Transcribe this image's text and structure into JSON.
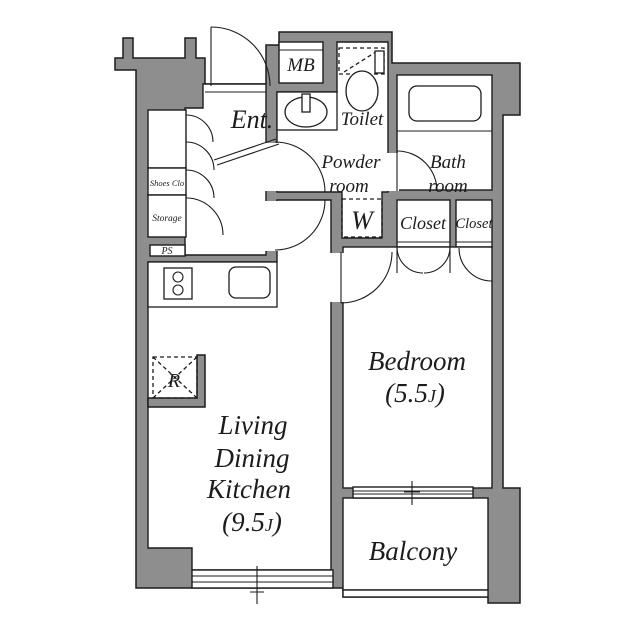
{
  "colors": {
    "wall_fill": "#8e8e8e",
    "line": "#1c1c1c",
    "floor": "#ffffff"
  },
  "rooms": {
    "entrance": {
      "label": "Ent."
    },
    "meter_box": {
      "label": "MB"
    },
    "toilet": {
      "label": "Toilet"
    },
    "powder_room": {
      "line1": "Powder",
      "line2": "room"
    },
    "bath_room": {
      "line1": "Bath",
      "line2": "room"
    },
    "washer_space": {
      "label": "W"
    },
    "closet_large": {
      "label": "Closet"
    },
    "closet_small": {
      "label": "Closet"
    },
    "bedroom": {
      "label": "Bedroom",
      "area_prefix": "(5.5",
      "area_unit": "J",
      "area_suffix": ")"
    },
    "ldk": {
      "line1": "Living",
      "line2": "Dining",
      "line3": "Kitchen",
      "area_prefix": "(9.5",
      "area_unit": "J",
      "area_suffix": ")"
    },
    "balcony": {
      "label": "Balcony"
    },
    "shoes_closet": {
      "label": "Shoes Clo"
    },
    "storage": {
      "label": "Storage"
    },
    "pipe_space": {
      "label": "PS"
    },
    "refrigerator": {
      "label": "R"
    }
  }
}
